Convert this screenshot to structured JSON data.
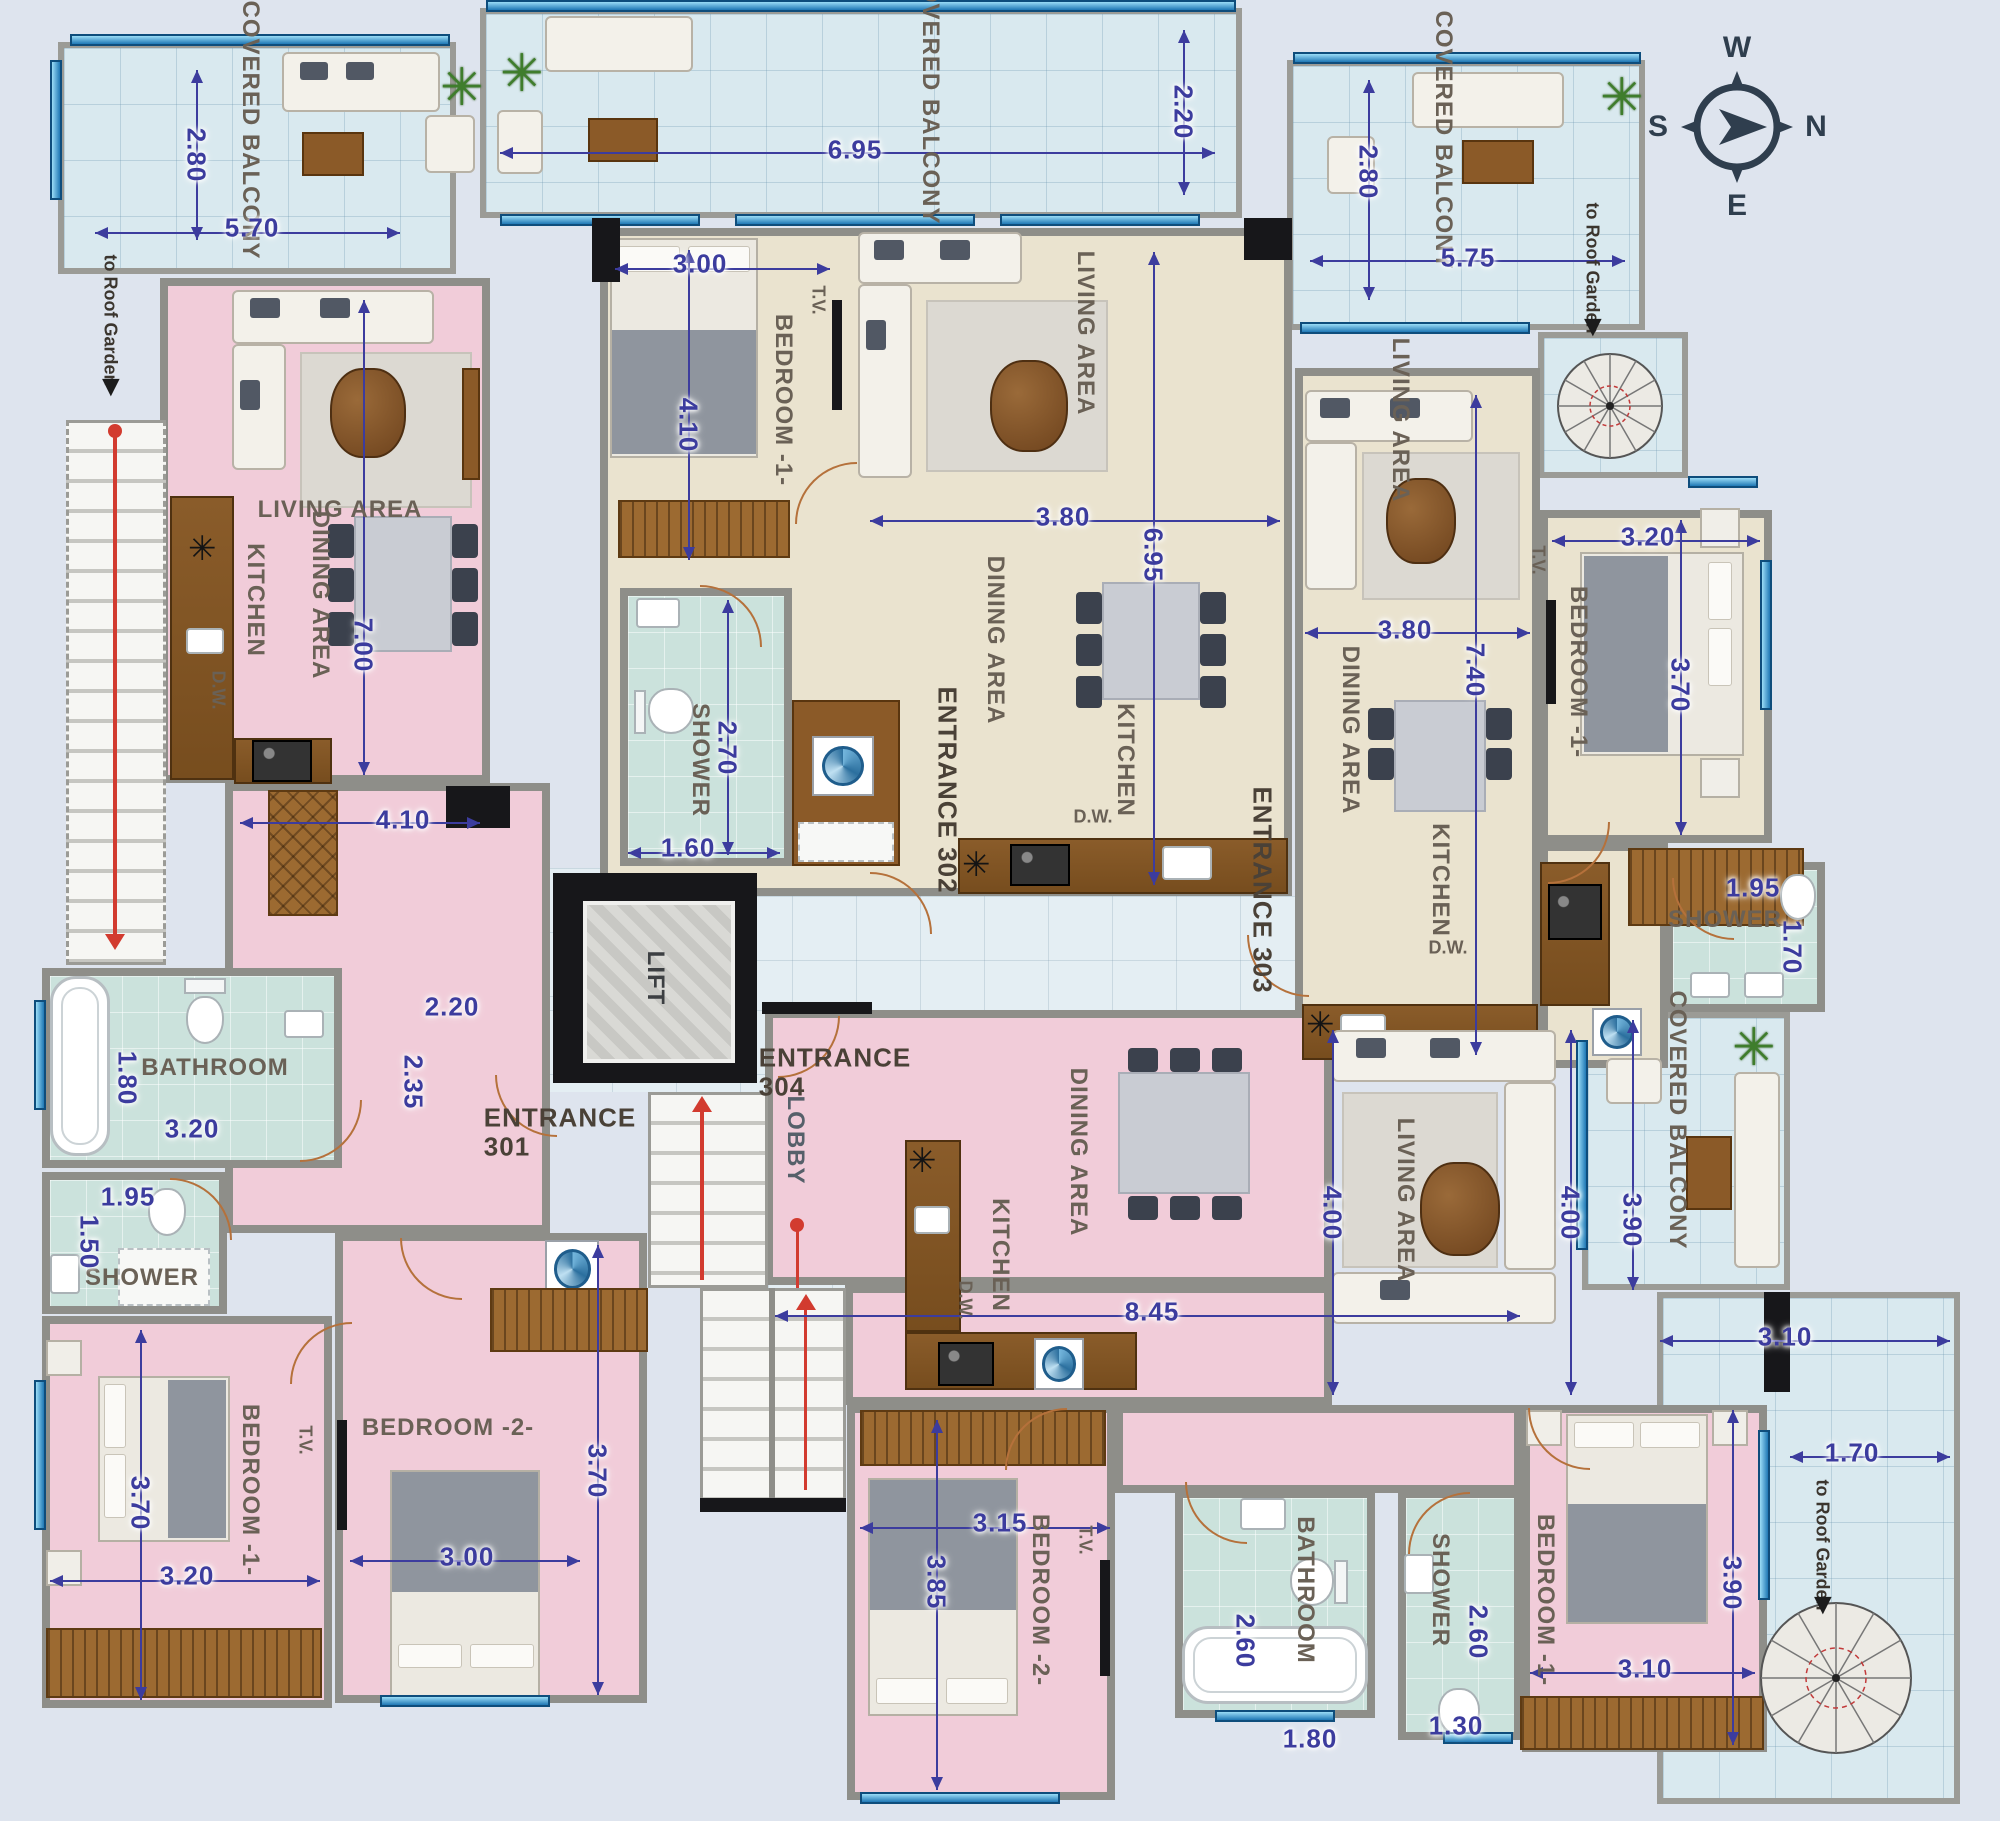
{
  "labels": {
    "covered_balcony": "COVERED BALCONY",
    "to_roof_garden": "to Roof Garden",
    "living_area": "LIVING AREA",
    "dining_area": "DINING AREA",
    "kitchen": "KITCHEN",
    "dw": "D.W.",
    "tv": "T.V.",
    "shower": "SHOWER",
    "bathroom": "BATHROOM",
    "bedroom1": "BEDROOM -1-",
    "bedroom2": "BEDROOM -2-",
    "entrance": "ENTRANCE",
    "lift": "LIFT",
    "lobby": "LOBBY"
  },
  "units": {
    "u301": "301",
    "u302": "302",
    "u303": "303",
    "u304": "304"
  },
  "compass": {
    "n": "N",
    "e": "E",
    "s": "S",
    "w": "W"
  },
  "icons": {
    "down_arrow": "▼",
    "plant": "✳",
    "fixture": "✳"
  },
  "dims": {
    "b_tl_h": "2.80",
    "b_tl_w": "5.70",
    "b_top_w": "6.95",
    "b_top_h": "2.20",
    "b_tr_h": "2.80",
    "b_tr_w": "5.75",
    "a302_bd1_w": "3.00",
    "a302_bd1_h": "4.10",
    "a302_sh_h": "2.70",
    "a302_sh_w": "1.60",
    "a302_liv_w": "3.80",
    "a302_liv_h": "6.95",
    "a303_liv_w": "3.80",
    "a303_liv_h": "7.40",
    "a303_bd1_w": "3.20",
    "a303_bd1_h": "3.70",
    "a303_sh_w": "1.95",
    "a303_sh_h": "1.70",
    "a301_liv_h": "7.00",
    "a301_liv_w": "4.10",
    "a301_corr_w": "2.20",
    "a301_corr_h": "2.35",
    "a301_bath_h": "1.80",
    "a301_bath_w": "3.20",
    "a301_sh_w": "1.95",
    "a301_sh_h": "1.50",
    "a301_bd1_h": "3.70",
    "a301_bd1_w": "3.20",
    "a301_bd2_h": "3.70",
    "a301_bd2_w": "3.00",
    "a304_liv_w": "8.45",
    "a304_liv_h_l": "4.00",
    "a304_liv_h_r": "4.00",
    "b_r_h": "3.90",
    "b_br_w": "3.10",
    "b_br_h": "1.70",
    "a304_bd2_w": "3.15",
    "a304_bd2_h": "3.85",
    "a304_bath_h": "2.60",
    "a304_bath_w": "1.80",
    "a304_sh_h": "2.60",
    "a304_sh_w": "1.30",
    "a304_bd1_h": "3.90",
    "a304_bd1_w": "3.10"
  }
}
